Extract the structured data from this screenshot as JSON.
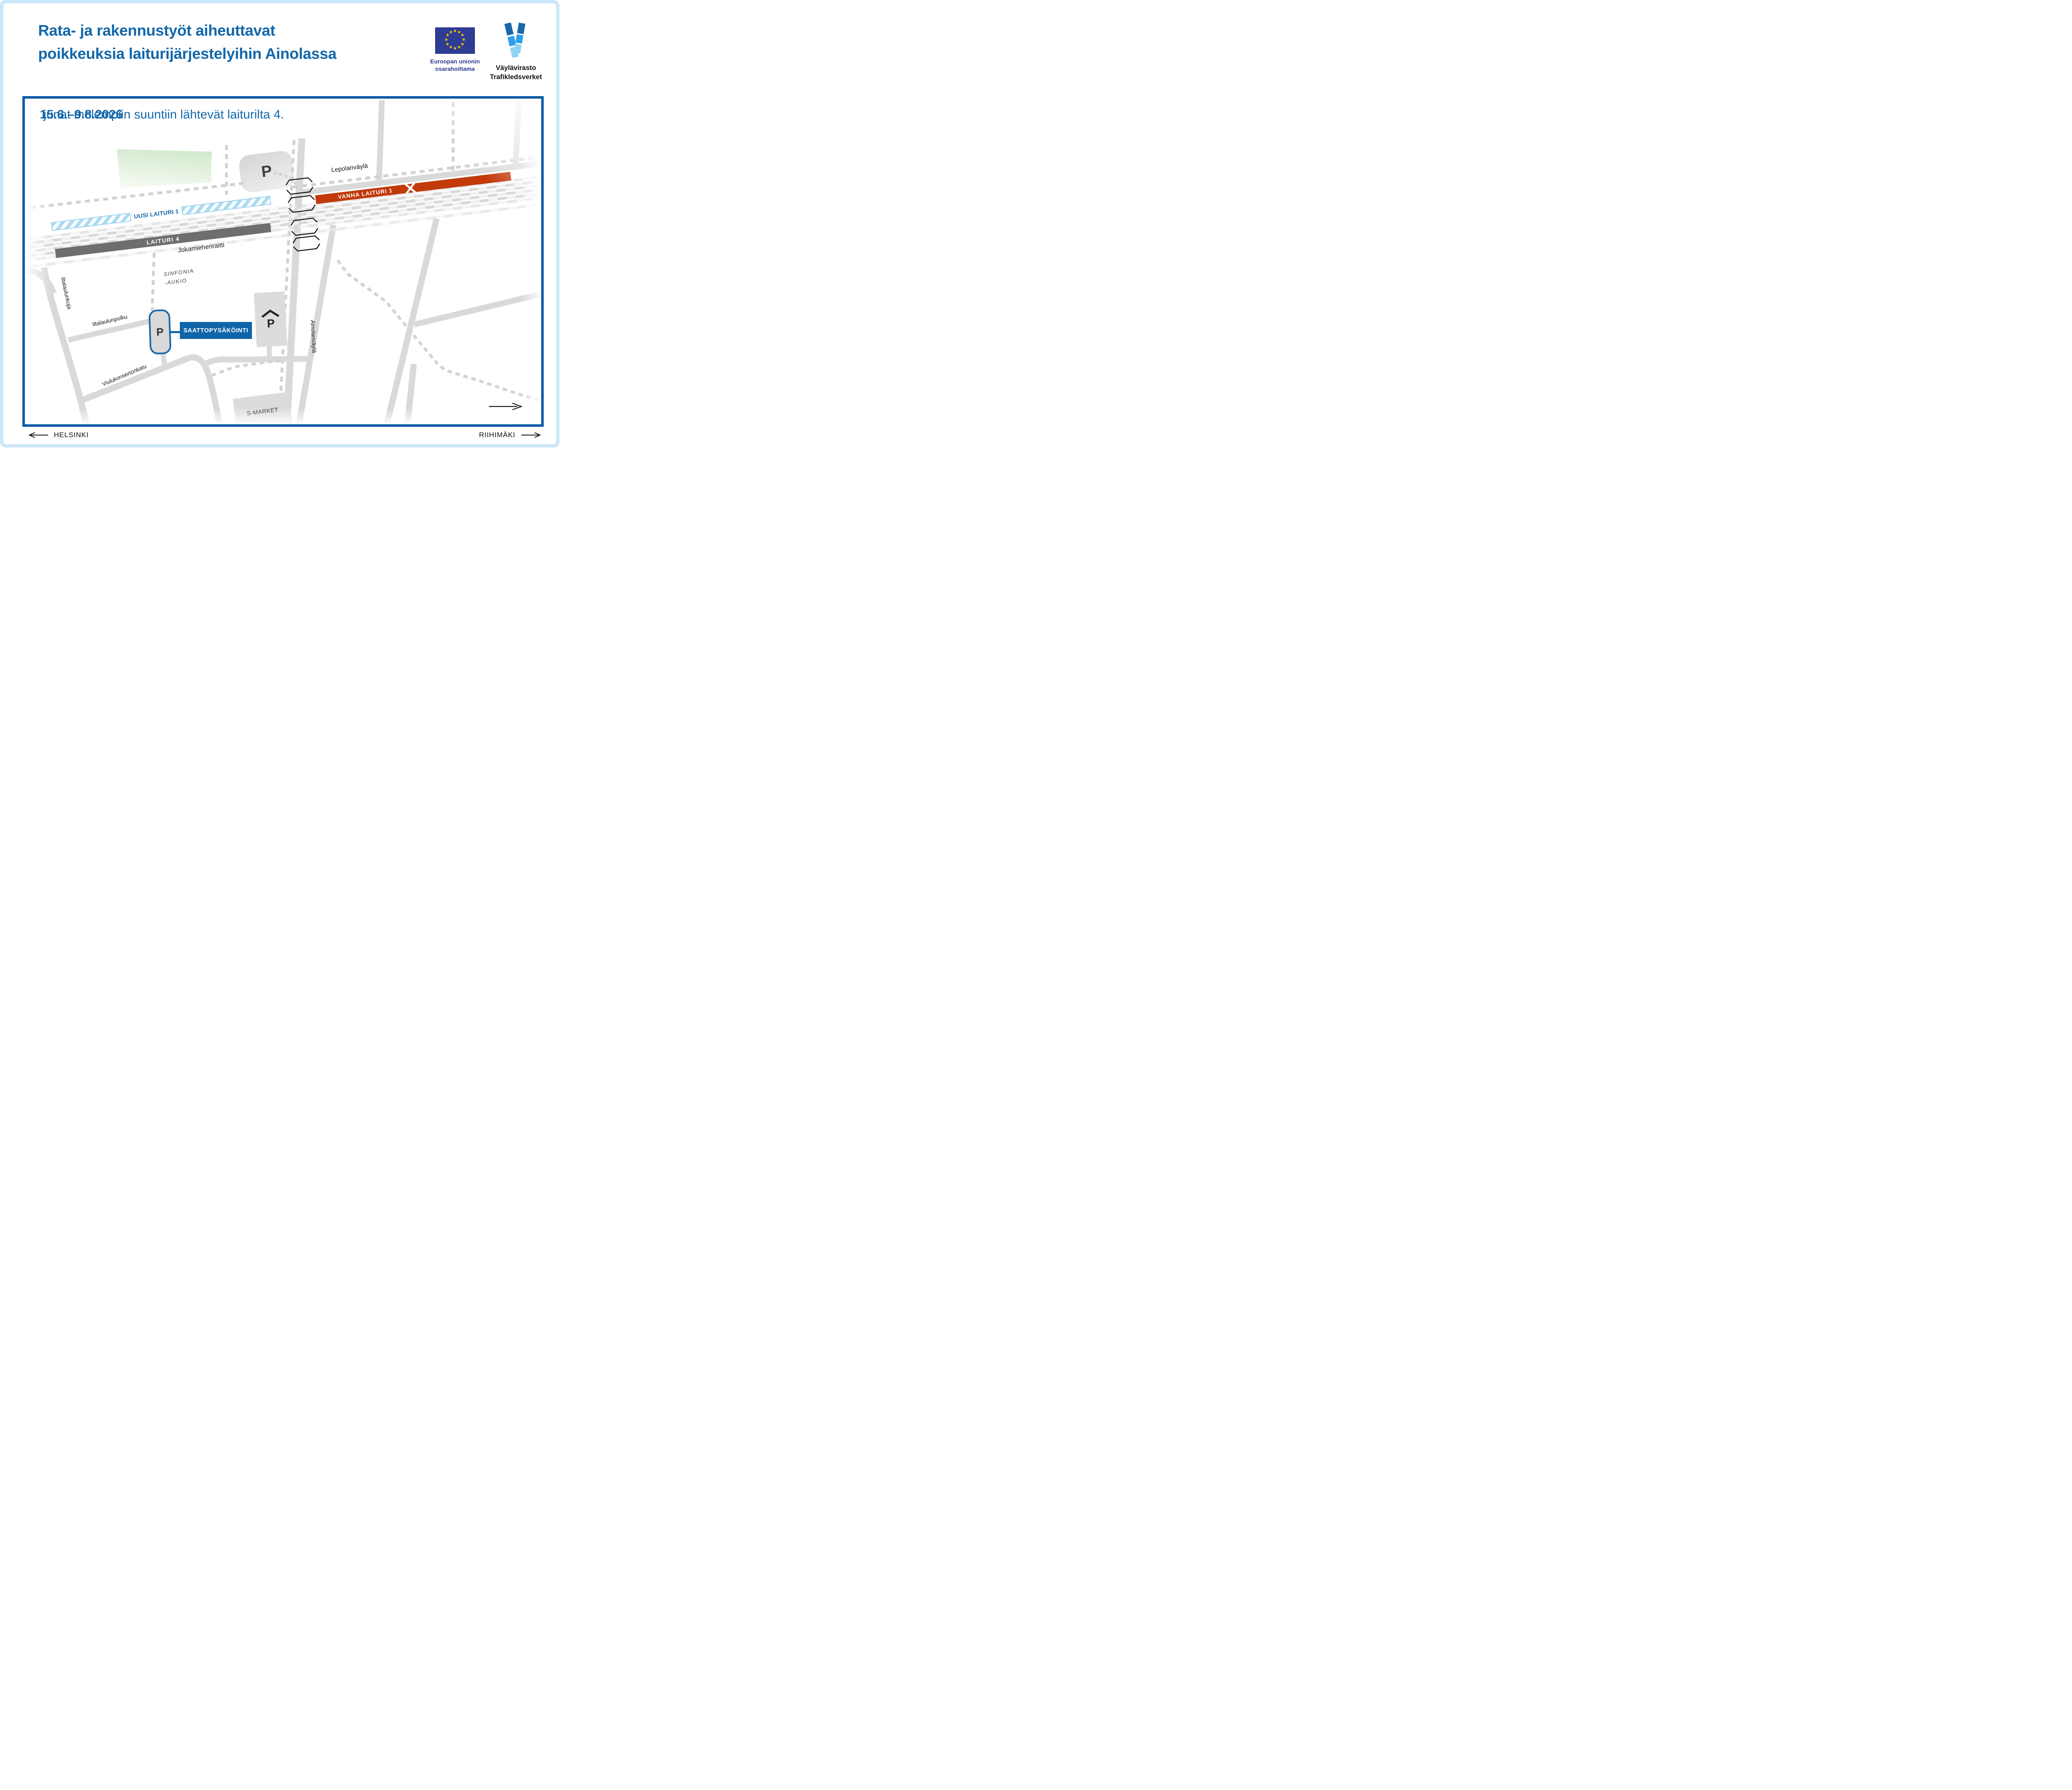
{
  "header": {
    "title_line1": "Rata- ja rakennustyöt aiheuttavat",
    "title_line2": "poikkeuksia laiturijärjestelyihin Ainolassa"
  },
  "logos": {
    "eu_caption_line1": "Euroopan unionin",
    "eu_caption_line2": "osarahoittama",
    "vayla_name_fi": "Väylävirasto",
    "vayla_name_sv": "Trafikledsverket"
  },
  "notice": {
    "dates": "15.6.–9.8.2026",
    "text": "junat molempiin suuntiin lähtevät laiturilta 4."
  },
  "map_labels": {
    "lepolanvayla": "Lepolanväylä",
    "vanha_laituri1": "VANHA LAITURI 1",
    "uusi_laituri1": "UUSI LAITURI 1",
    "laituri4": "LAITURI 4",
    "jokamiehenraitti": "Jokamiehenraitti",
    "sinfonia_line1": "SINFONIA",
    "sinfonia_line2": "-AUKIO",
    "iltalaulunkuja": "Iltalaulunkuja",
    "iltalaulunpolku": "Iltalaulunpolku",
    "viulukonsertonkatu": "Viulukonsertonkatu",
    "ainolanvayla": "Ainolanväylä",
    "saattopysakointi": "SAATTOPYSÄKÖINTI",
    "s_market": "S-MARKET",
    "parking_letter": "P"
  },
  "footer": {
    "west_label": "HELSINKI",
    "east_label": "RIIHIMÄKI"
  },
  "colors": {
    "title_blue": "#1267a9",
    "map_border_blue": "#0c5aa5",
    "accent_blue": "#0f65a9",
    "eu_flag_blue": "#2e3c94",
    "eu_star_yellow": "#ffcc00",
    "old_platform_orange": "#c23a0a",
    "new_platform_lightblue": "#a9dbf3",
    "platform4_gray": "#6e6e6e",
    "road_gray": "#d9d9d9"
  }
}
